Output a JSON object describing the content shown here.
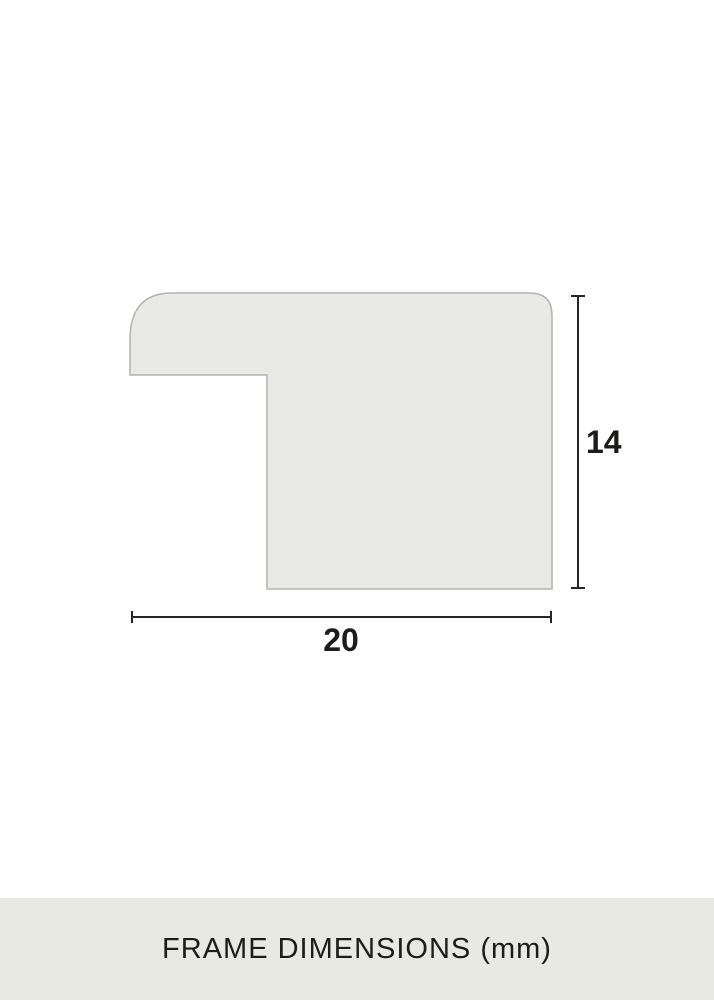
{
  "diagram": {
    "title": "frame-profile-cross-section",
    "dimensions": {
      "width_value": "20",
      "height_value": "14",
      "unit": "mm"
    },
    "colors": {
      "shape_fill": "#e9e9e6",
      "shape_border": "#b2b2af",
      "line_color": "#262624",
      "background": "#ffffff",
      "footer_background": "#e9e9e4",
      "text_color": "#1c1c1a"
    }
  },
  "footer": {
    "caption": "FRAME DIMENSIONS (mm)"
  }
}
